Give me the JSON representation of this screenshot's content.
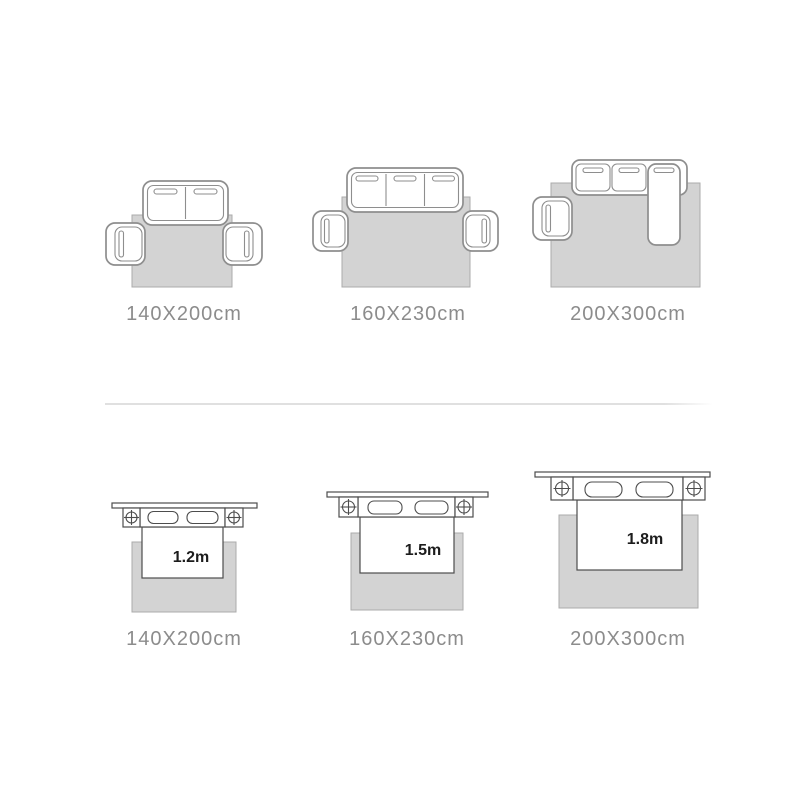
{
  "colors": {
    "rug_fill": "#d3d3d3",
    "rug_stroke": "#ababab",
    "sofa_stroke": "#8e8e8e",
    "bed_stroke": "#4d4d4d",
    "caption_color": "#8c8c8c",
    "bed_label_color": "#1c1c1c",
    "divider_color": "#e0e0e0",
    "background": "#ffffff"
  },
  "sofa_row": {
    "items": [
      {
        "size_label": "140X200cm",
        "scene": "two-seat-sofa-two-armchairs"
      },
      {
        "size_label": "160X230cm",
        "scene": "three-seat-sofa-two-armchairs"
      },
      {
        "size_label": "200X300cm",
        "scene": "l-shaped-sofa-one-armchair"
      }
    ]
  },
  "bed_row": {
    "items": [
      {
        "size_label": "140X200cm",
        "bed_width": "1.2m"
      },
      {
        "size_label": "160X230cm",
        "bed_width": "1.5m"
      },
      {
        "size_label": "200X300cm",
        "bed_width": "1.8m"
      }
    ]
  }
}
